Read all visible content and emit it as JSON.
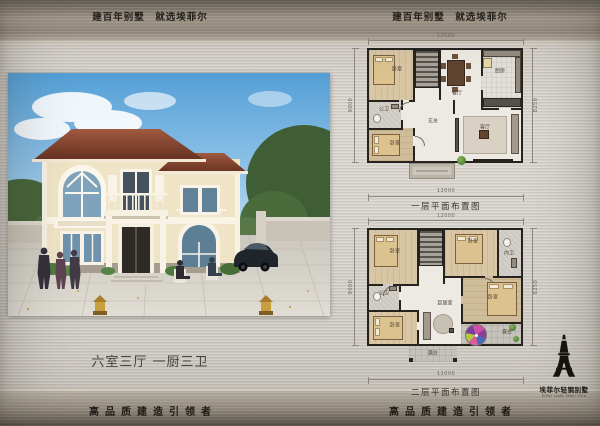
{
  "header": {
    "left": "建百年别墅　就选埃菲尔",
    "right": "建百年别墅　就选埃菲尔"
  },
  "left_panel": {
    "spec": "六室三厅 一厨三卫",
    "footer": "高品质建造引领者"
  },
  "right_panel": {
    "footer": "高品质建造引领者"
  },
  "plans": [
    {
      "caption": "一层平面布置图",
      "dims": {
        "top": "12000",
        "bottom": "12000",
        "left": "9000",
        "right": "8250"
      },
      "rooms": {
        "bedroom_tl": "卧室",
        "dining": "餐厅",
        "kitchen": "厨房",
        "bath": "公卫",
        "foyer": "玄关",
        "living": "客厅",
        "bedroom_bl": "卧室"
      }
    },
    {
      "caption": "二层平面布置图",
      "dims": {
        "top": "12000",
        "bottom": "12000",
        "left": "9000",
        "right": "8250"
      },
      "rooms": {
        "bedroom_tl": "卧室",
        "bedroom_tr": "卧室",
        "ensuite": "内卫",
        "bath": "公卫",
        "bedroom_mr": "卧室",
        "bedroom_bl": "卧室",
        "family": "起居室",
        "terrace_r": "露台",
        "terrace_b": "露台"
      }
    }
  ],
  "logo": {
    "cn": "埃菲尔轻钢别墅",
    "en": "Eiffel Light Steel Villa"
  },
  "colors": {
    "metal_light": "#d6d2cb",
    "metal_band": "#8d8478",
    "roof": "#7c3e2c",
    "wall_cream": "#efe4c6",
    "sky": "#6fb3e0",
    "umbrella_pink": "#cf4fa2"
  }
}
